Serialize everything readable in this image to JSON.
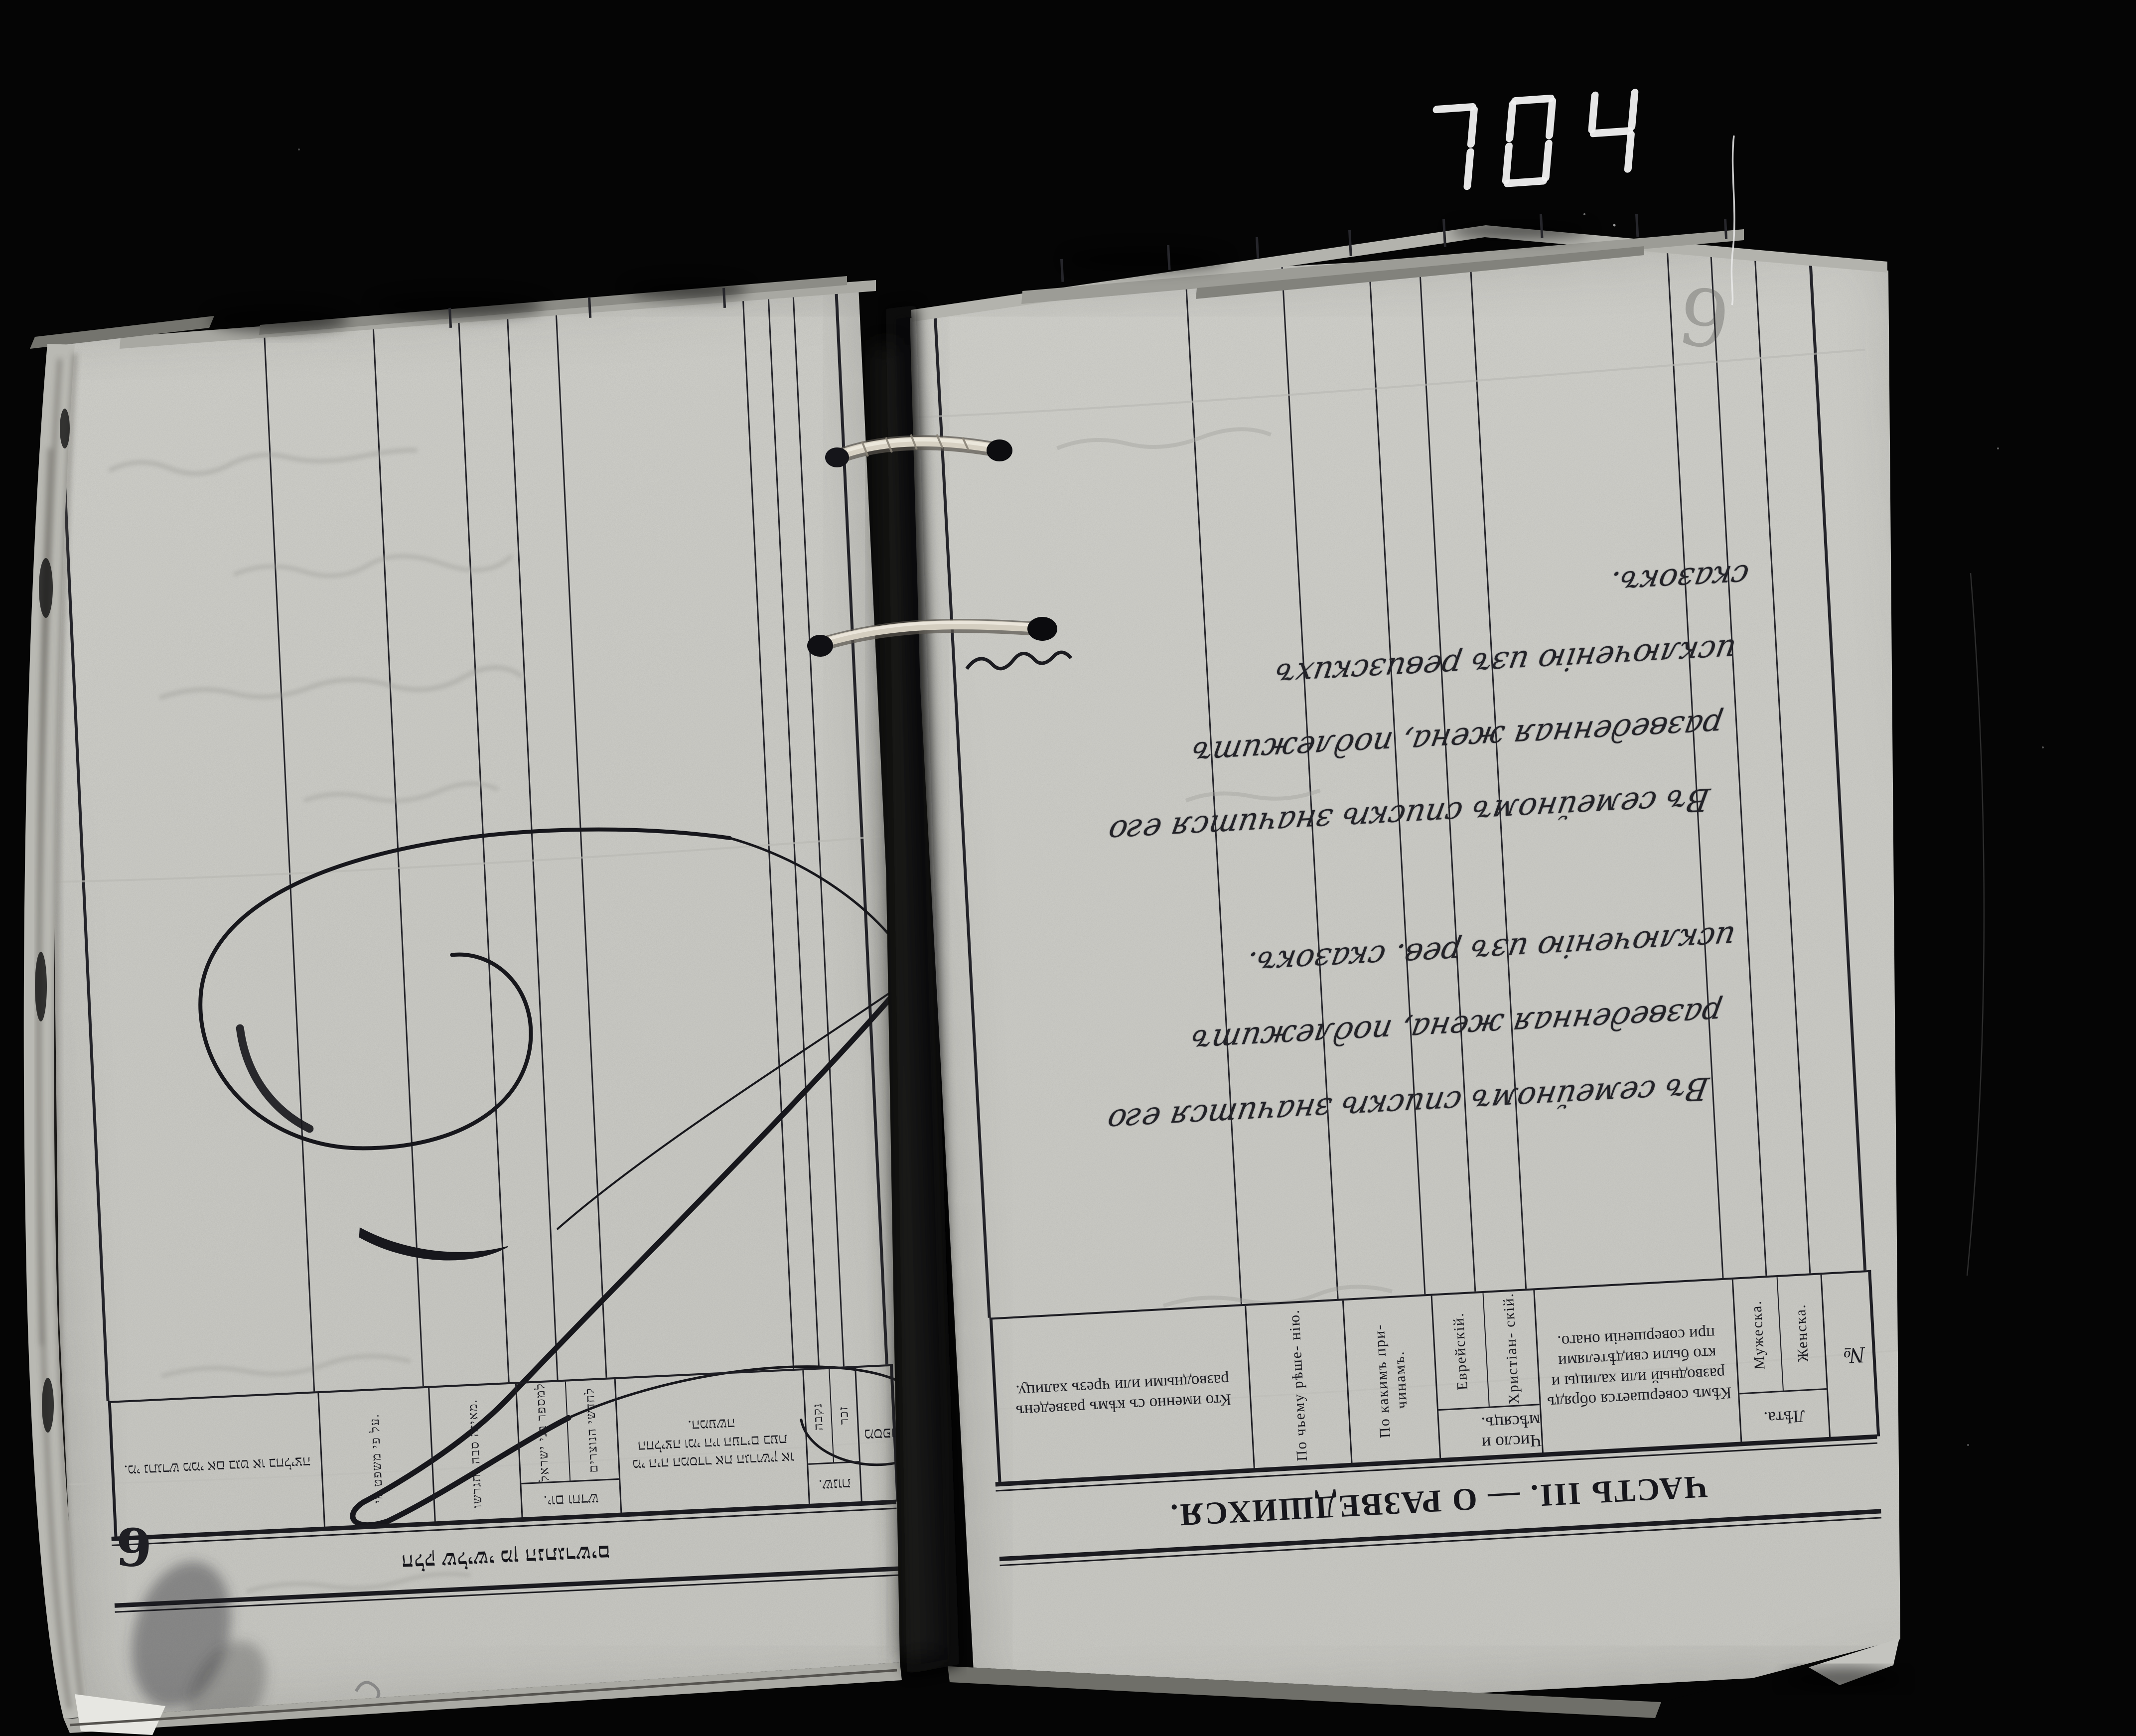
{
  "photo": {
    "counter_value": "704",
    "background_color": "#050505",
    "paper_color": "#d6d6d1",
    "ink_color": "#1b1b20",
    "description_labels": {
      "counter": "seven-segment-frame-counter",
      "binding": "twine-binding-strings",
      "flourish": "large-z-shaped-pen-flourish"
    }
  },
  "right_page": {
    "language": "Russian",
    "orientation": "upside-down",
    "title": "ЧАСТЬ III. — О РАЗВЕДШИХСЯ.",
    "pencil_number": "9",
    "columns": [
      {
        "label": "Кто именно съ кѣмъ разведенъ разводными или чрезъ халицу.",
        "width_pct": 27.5
      },
      {
        "label": "По чьему рѣше- нію.",
        "vertical": true,
        "width_pct": 10.5
      },
      {
        "label": "По какимъ при- чинамъ.",
        "vertical": true,
        "width_pct": 9.5
      },
      {
        "label": "Число и мѣсяцъ.",
        "width_pct": 11,
        "subs": [
          {
            "label": "Еврейскій."
          },
          {
            "label": "Христіан- скій."
          }
        ]
      },
      {
        "label": "Кѣмъ совершается обрядъ разводный или халицы и кто были свидѣтелями при совершеніи онаго.",
        "width_pct": 21.5
      },
      {
        "label": "Лѣта.",
        "width_pct": 9.5,
        "subs": [
          {
            "label": "Мужеска."
          },
          {
            "label": "Женска."
          }
        ]
      },
      {
        "label": "№",
        "num": true,
        "width_pct": 6
      }
    ],
    "annotations": [
      {
        "lines": [
          "Въ семейномъ спискѣ значится его",
          "разведенная жена, подлежитъ",
          "исключенію изъ ревизскихъ",
          "сказокъ."
        ]
      },
      {
        "lines": [
          "Въ семейномъ спискѣ значится его",
          "разведенная жена, подлежитъ",
          "исключенію изъ рев. сказокъ."
        ]
      }
    ]
  },
  "left_page": {
    "language": "Hebrew",
    "orientation": "upside-down",
    "title": "חלק שלישי מן הנתגרשים",
    "handwritten_number": "9",
    "columns": [
      {
        "label": "מי נתגרש ממי אם בגט או בחליצה.",
        "width_pct": 26.5
      },
      {
        "label": "על פי משפט מי.",
        "vertical": true,
        "width_pct": 14
      },
      {
        "label": "מאיזה סבה נתגרשו.",
        "vertical": true,
        "width_pct": 11
      },
      {
        "label": "יום וחדש.",
        "width_pct": 12.5,
        "subs": [
          {
            "label": "למספר בני ישראל"
          },
          {
            "label": "לחדשי הנוצרים"
          }
        ]
      },
      {
        "label": "מי היה המסדר את הגרושין או החליצה ומי היו העדים בעת המעשה.",
        "width_pct": 24
      },
      {
        "label": "שנות.",
        "width_pct": 6.5,
        "subs": [
          {
            "label": "נקבה"
          },
          {
            "label": "זכר"
          }
        ]
      },
      {
        "label": "מספר",
        "num": true,
        "width_pct": 5.5
      }
    ]
  }
}
